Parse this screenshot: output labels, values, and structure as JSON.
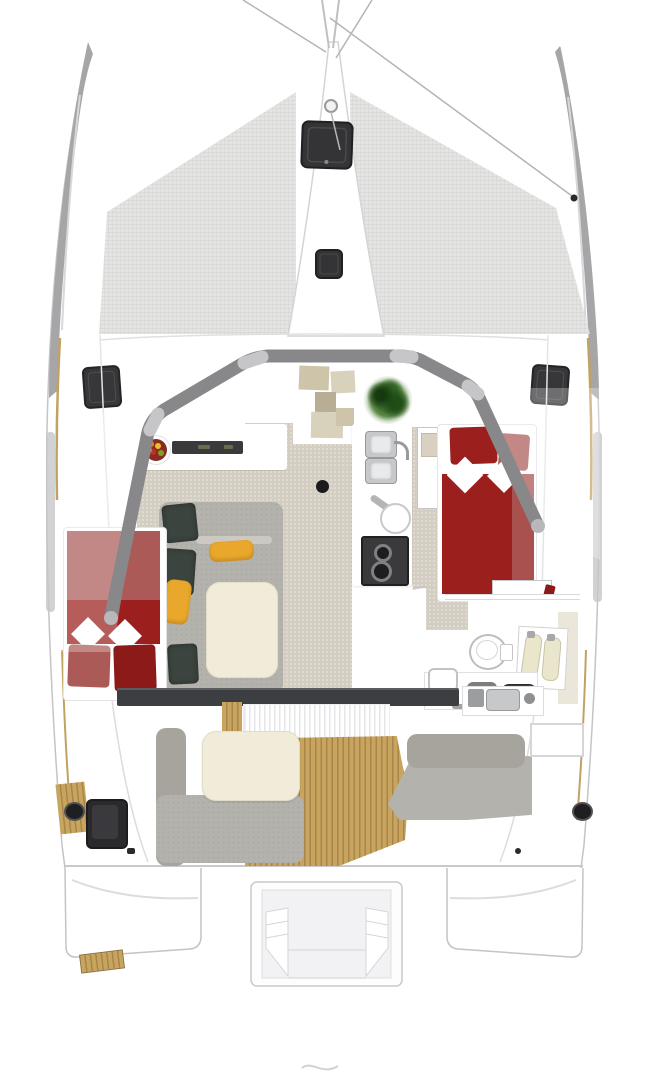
{
  "figure": {
    "type": "boat-floor-plan",
    "subject": "catamaran-top-view-interior-layout",
    "text_labels": []
  },
  "palette": {
    "hull_gray": "#a6a6a8",
    "hull_highlight": "#d8d8da",
    "mesh_bg": "#e4e4e2",
    "mesh_line": "#cdcdcb",
    "outline": "#c6c6c8",
    "structure": "#88888a",
    "beam_cap": "#b8b8ba",
    "carpet": "#d4cdc1",
    "sofa": "#b4b2ac",
    "sofa_dark": "#a7a49e",
    "sofa_bar": "#ccc9c3",
    "pillow_dark": "#3c443f",
    "pillow_yellow": "#e9a82b",
    "cream": "#f1ebd9",
    "bed_red": "#9a1f1d",
    "bed_red_muted": "#ab5a58",
    "bed_red_deep": "#8c1a18",
    "teak": "#c8a55f",
    "teak_line": "#a9854a",
    "hatch": "#343436",
    "hatch_border": "#202022",
    "appliance": "#3a3a3c",
    "burner": "#1d1d1f",
    "steel": "#c6c8ca",
    "steel_dark": "#97999b",
    "plant": "#3f6b2f",
    "step_tan_1": "#cdc4aa",
    "step_tan_2": "#d8d1bc",
    "step_tan_3": "#b8ae95",
    "door_band": "#3c3e42",
    "toe_rail": "#c2a264",
    "window_gray": "#c7c7c9",
    "fruit_bowl": "#8a2a22",
    "fruit_orange": "#e0861e",
    "fruit_yellow": "#e8c030",
    "fruit_red": "#c03028",
    "fruit_green": "#7fa02c",
    "bottle": "#eae6cb",
    "bottle_line": "#c8c4a8",
    "glass_veil": "rgba(255,255,255,0.28)"
  },
  "regions": {
    "bow": [
      "port-hull-bow",
      "starboard-hull-bow",
      "bowsprit-rigging",
      "port-trampoline",
      "starboard-trampoline",
      "anchor-pod",
      "foredeck-hatch-large",
      "foredeck-hatch-small",
      "windlass"
    ],
    "foredeck": [
      "deck-hatch-port",
      "deck-hatch-starboard",
      "cabin-roof-arch"
    ],
    "salon": [
      "beige-carpet",
      "l-shaped-sofa",
      "dark-pillows-x3",
      "yellow-pillows-x2",
      "cream-ottoman-table",
      "companionway-steps",
      "potted-plant",
      "fruit-bowl",
      "counter-with-appliance"
    ],
    "galley_island": [
      "double-sink",
      "faucet",
      "prep-bowl",
      "two-burner-stove"
    ],
    "port_cabin": [
      "red-double-berth",
      "two-red-pillows"
    ],
    "starboard_cabin": [
      "red-double-berth",
      "two-red-pillows",
      "nightstand",
      "hanging-locker-with-clothes"
    ],
    "bathroom": [
      "toilet",
      "vanity-with-dark-basins",
      "bottle-tray",
      "door-swing-arc",
      "shower-panel"
    ],
    "cockpit": [
      "sliding-door-band",
      "door-track",
      "teak-deck",
      "l-shaped-cockpit-sofa",
      "cream-cockpit-table",
      "aft-bench",
      "outdoor-galley-module",
      "winch-port",
      "winch-starboard",
      "side-window"
    ],
    "stern": [
      "port-transom-steps",
      "starboard-transom-steps",
      "central-swim-platform-with-stairs",
      "teak-boarding-step"
    ]
  },
  "counts": {
    "sinks_galley": 2,
    "stove_burners": 2,
    "dark_sofa_pillows": 3,
    "yellow_sofa_pillows": 2,
    "red_pillows_per_cabin": 2,
    "foredeck_hatches": 2,
    "side_deck_hatches": 2,
    "trampolines": 2,
    "winches": 2,
    "bottles": 2
  }
}
